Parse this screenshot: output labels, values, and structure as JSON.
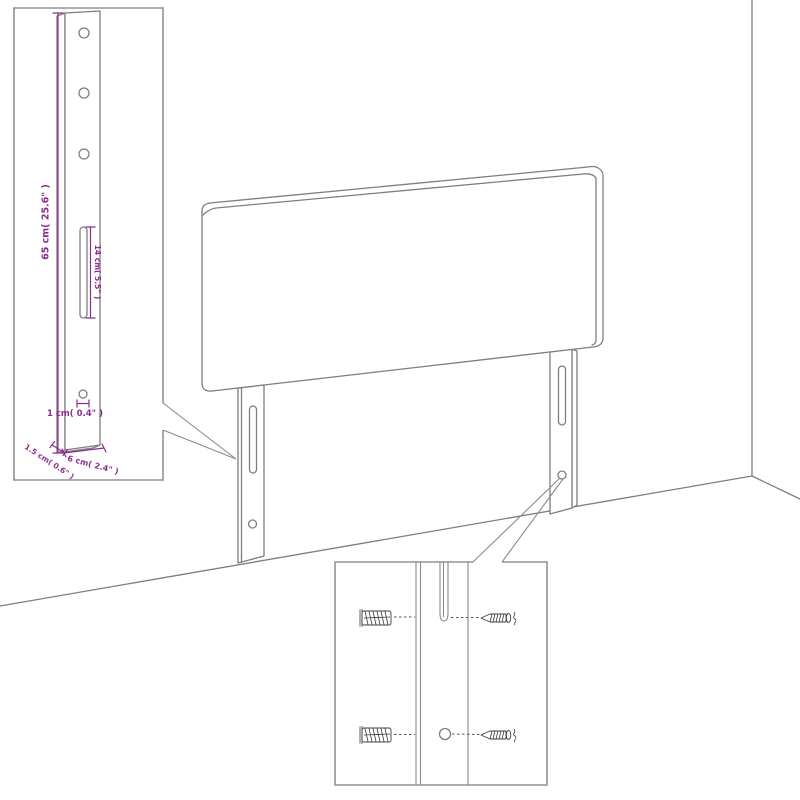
{
  "diagram": {
    "type": "headboard-assembly-dimension-diagram",
    "inset_leg_detail": {
      "height_label": "65 cm( 25.6\" )",
      "slot_label": "14 cm( 5.5\" )",
      "hole_label": "1 cm( 0.4\" )",
      "depth_label": "1.5 cm( 0.6\" )",
      "width_label": "6 cm( 2.4\" )"
    },
    "colors": {
      "dimension_text": "#8b2e8b",
      "drawing_line": "#7e7e7e",
      "inset_border": "#929292",
      "hardware_line": "#3f3f3f",
      "background": "#ffffff"
    }
  }
}
